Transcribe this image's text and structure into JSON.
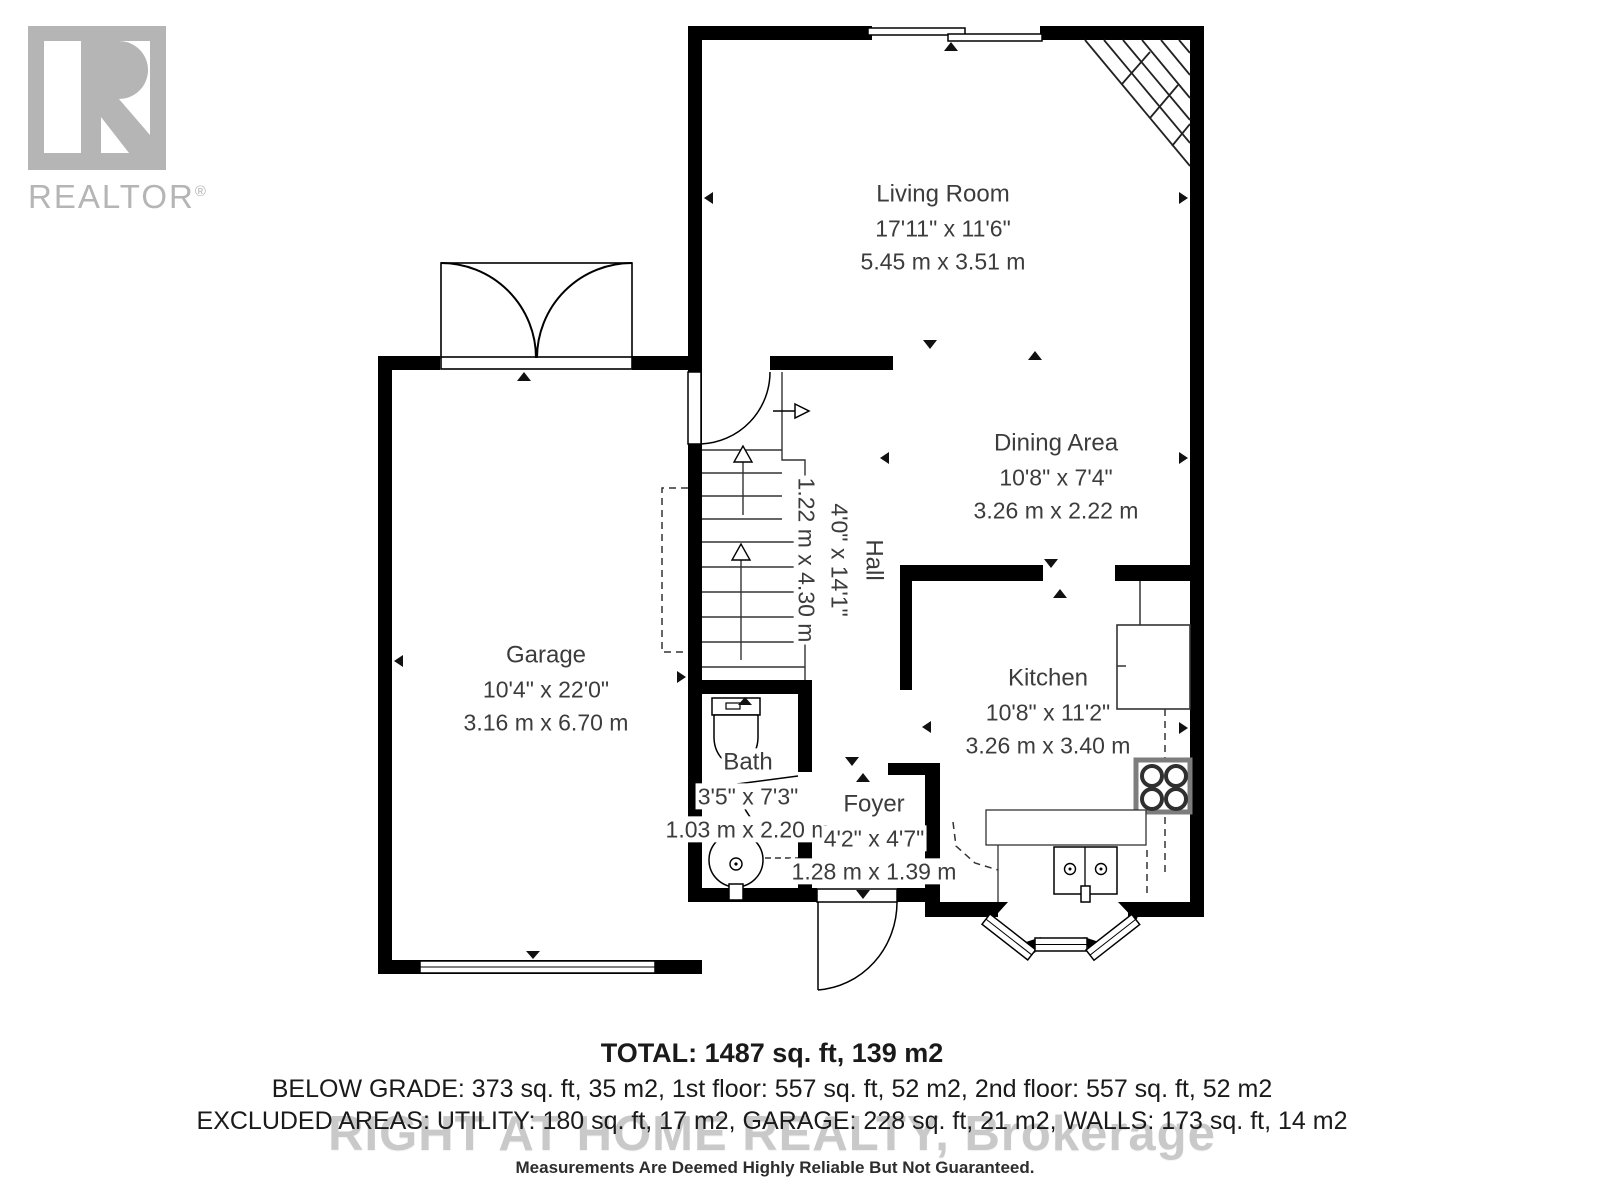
{
  "branding": {
    "logo_text": "REALTOR",
    "reg": "®"
  },
  "rooms": [
    {
      "id": "living-room",
      "name": "Living Room",
      "imperial": "17'11\" x 11'6\"",
      "metric": "5.45 m x 3.51 m"
    },
    {
      "id": "dining-area",
      "name": "Dining Area",
      "imperial": "10'8\" x 7'4\"",
      "metric": "3.26 m x 2.22 m"
    },
    {
      "id": "hall",
      "name": "Hall",
      "imperial": "4'0\" x 14'1\"",
      "metric": "1.22 m x 4.30 m"
    },
    {
      "id": "garage",
      "name": "Garage",
      "imperial": "10'4\" x 22'0\"",
      "metric": "3.16 m x 6.70 m"
    },
    {
      "id": "kitchen",
      "name": "Kitchen",
      "imperial": "10'8\" x 11'2\"",
      "metric": "3.26 m x 3.40 m"
    },
    {
      "id": "bath",
      "name": "Bath",
      "imperial": "3'5\" x 7'3\"",
      "metric": "1.03 m x 2.20 m"
    },
    {
      "id": "foyer",
      "name": "Foyer",
      "imperial": "4'2\" x 4'7\"",
      "metric": "1.28 m x 1.39 m"
    }
  ],
  "summary": {
    "total": "TOTAL: 1487 sq. ft, 139 m2",
    "breakdown": "BELOW GRADE: 373 sq. ft, 35 m2, 1st floor: 557 sq. ft, 52 m2, 2nd floor: 557 sq. ft, 52 m2",
    "excluded": "EXCLUDED AREAS: UTILITY: 180 sq. ft, 17 m2, GARAGE: 228 sq. ft, 21 m2, WALLS: 173 sq. ft, 14 m2",
    "watermark": "RIGHT AT HOME REALTY, Brokerage",
    "disclaimer": "Measurements Are Deemed Highly Reliable But Not Guaranteed."
  },
  "colors": {
    "wall": "#000000",
    "logo_gray": "#b5b5b5",
    "label_text": "#3c3c3c",
    "watermark_gray": "#c9c9c9"
  }
}
